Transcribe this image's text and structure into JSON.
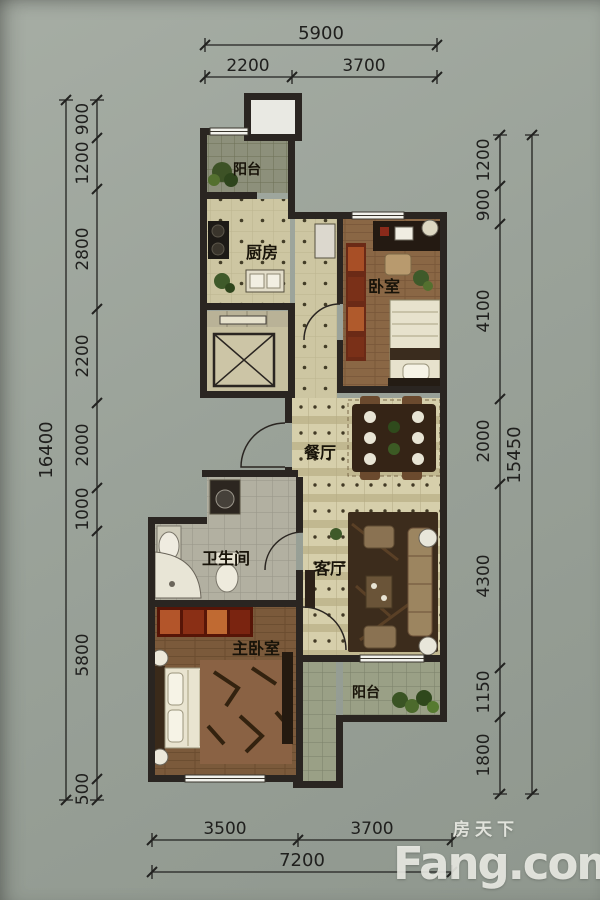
{
  "plan": {
    "rooms": {
      "balcony_top": {
        "label": "阳台"
      },
      "kitchen": {
        "label": "厨房"
      },
      "bedroom": {
        "label": "卧室"
      },
      "dining": {
        "label": "餐厅"
      },
      "bathroom": {
        "label": "卫生间"
      },
      "living": {
        "label": "客厅"
      },
      "master_bedroom": {
        "label": "主卧室"
      },
      "balcony_bottom": {
        "label": "阳台"
      }
    }
  },
  "dimensions": {
    "top": {
      "total": "5900",
      "segments": [
        "2200",
        "3700"
      ]
    },
    "bottom": {
      "total": "7200",
      "segments": [
        "3500",
        "3700"
      ]
    },
    "left": {
      "total": "16400",
      "segments": [
        "900",
        "1200",
        "2800",
        "2200",
        "2000",
        "1000",
        "5800",
        "500"
      ]
    },
    "right": {
      "total": "15450",
      "segments": [
        "1200",
        "900",
        "4100",
        "2000",
        "4300",
        "1150",
        "1800"
      ]
    }
  },
  "watermark": {
    "cn": "房天下",
    "en": "Fang.com"
  },
  "colors": {
    "background": "#9aa299",
    "wall": "#2a2521",
    "dim_text": "#20201e"
  }
}
